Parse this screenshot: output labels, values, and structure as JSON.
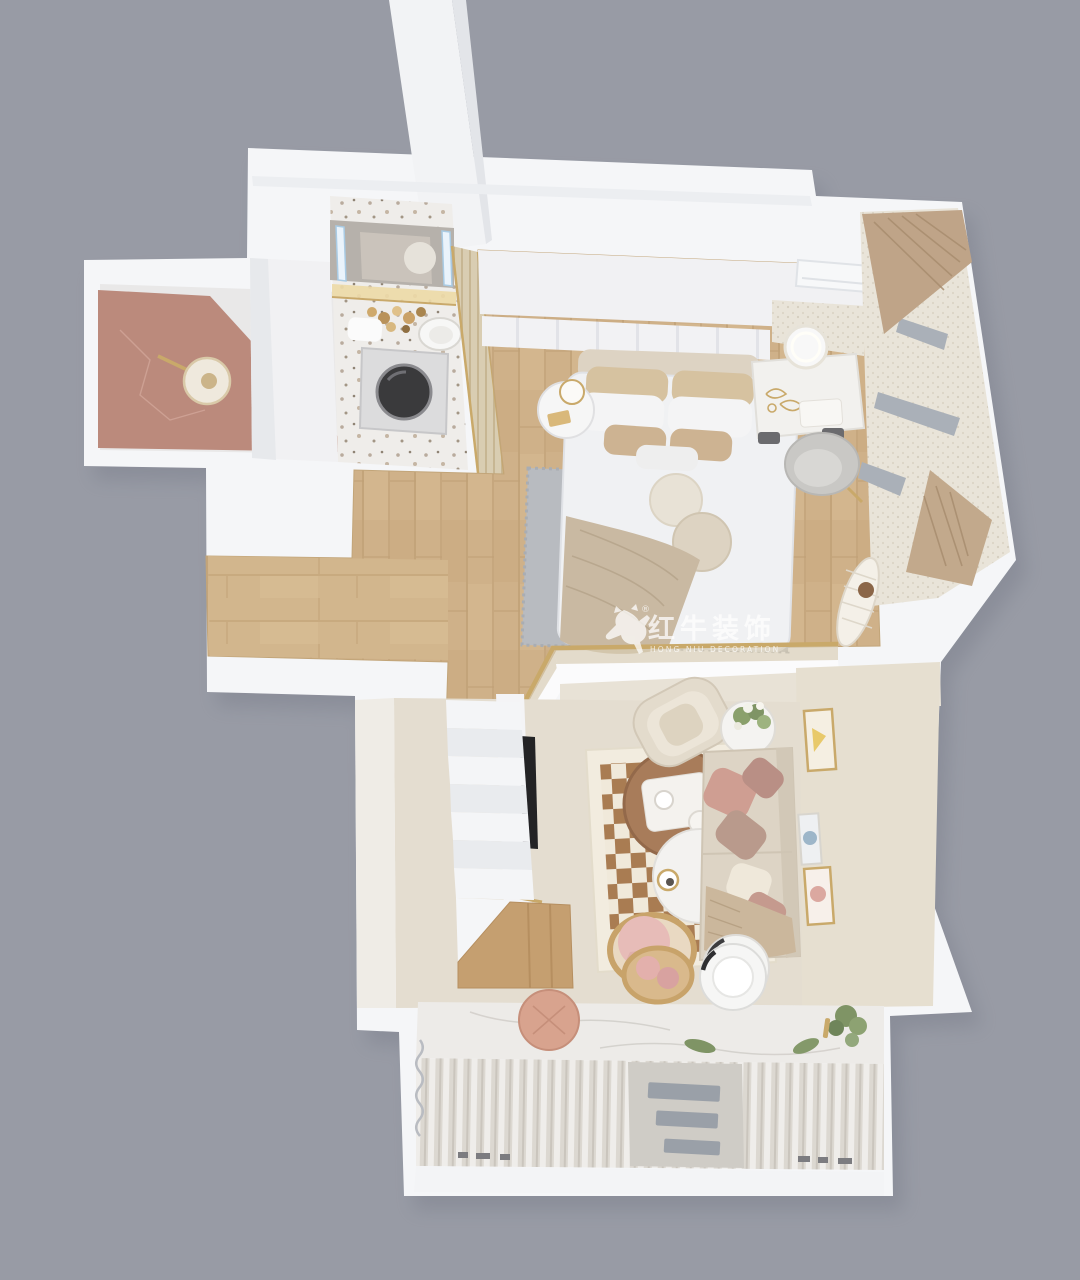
{
  "watermark": {
    "logo": "bull-logo-icon",
    "registered_symbol": "®",
    "brand_cn": "红牛装饰",
    "brand_en": "HONG NIU DECORATION",
    "color": "#ffffff"
  },
  "scene": {
    "type": "3d-top-down-loft-apartment-render",
    "background_color": "#989ba5",
    "rooms": [
      {
        "name": "shower-room",
        "wall_color": "#bb8a7c",
        "contents": [
          "rain-shower-head",
          "gold-shower-arm",
          "gold-towel-rails",
          "white-towel"
        ]
      },
      {
        "name": "bathroom",
        "contents": [
          "led-backlit-mirror",
          "gold-vanity-shelf",
          "cosmetic-bottles",
          "vessel-sink",
          "folded-towel",
          "washing-machine",
          "terrazzo-floor",
          "fluted-glass-partition"
        ]
      },
      {
        "name": "bedroom",
        "floor": "oak-planks",
        "contents": [
          "double-bed",
          "beige-and-white-pillows",
          "round-bolster-cushions",
          "taupe-throw-blanket",
          "gray-shag-rug",
          "round-nightstand",
          "table-lamp",
          "book",
          "vanity-desk",
          "round-makeup-mirror",
          "jewelry",
          "boucle-chair",
          "air-conditioner",
          "panel-headboard-wall",
          "beige-curtains",
          "sheer-window-band",
          "knit-bench-roll"
        ]
      },
      {
        "name": "stairwell",
        "contents": [
          "white-stairs",
          "wood-lower-steps",
          "gold-framed-glass-railing",
          "wall-mounted-tv",
          "media-wall"
        ]
      },
      {
        "name": "living-room",
        "floor": "cream",
        "contents": [
          "beige-sofa",
          "blush-throw-pillows",
          "fringed-throw",
          "checkered-rug",
          "round-wood-coffee-table",
          "serving-tray",
          "white-round-low-table",
          "armchair",
          "flower-side-table",
          "rattan-chair-with-pink-blanket",
          "white-drum-table",
          "three-wall-art-frames"
        ]
      },
      {
        "name": "balcony",
        "contents": [
          "marble-ledge",
          "blush-button-pouf",
          "rattan-basket",
          "white-appliance-cylinder",
          "green-plants",
          "gold-door-handle",
          "sheer-striped-curtains",
          "window-frames",
          "hanging-chain-decor"
        ]
      }
    ]
  },
  "palette": {
    "background_gray": "#989ba5",
    "wall_white": "#f5f6f8",
    "wood_floor": "#cfb189",
    "cream_floor": "#e4ddd0",
    "cream_wall": "#e6dfd0",
    "pink_marble_wall": "#bb8a7c",
    "gray_rug": "#b8bbc0",
    "sofa_beige": "#ddd4c5",
    "checker_brown": "#a97c52",
    "checker_cream": "#f0e9da",
    "gold_accent": "#c9a96a",
    "curtain_beige": "#bfa488",
    "tv_black": "#222222",
    "washer_door": "#3a3a3c",
    "plant_green": "#7f9465",
    "blush": "#cf9e92"
  }
}
